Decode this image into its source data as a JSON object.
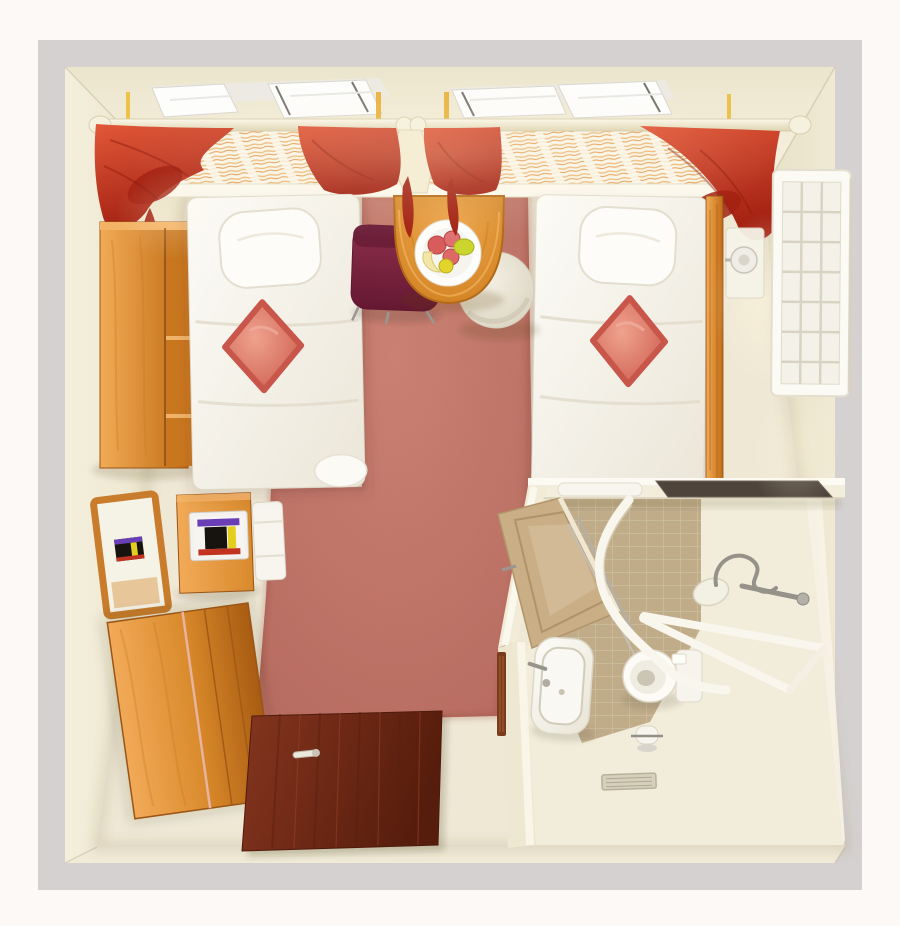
{
  "image": {
    "kind": "3d-floor-plan-render",
    "subject": "top-down view of a twin hotel guest room with accessible bathroom"
  },
  "palette": {
    "page_bg": "#fdf9f6",
    "wall_top": "#d5d1d0",
    "wall_face": "#f3eedb",
    "wall_face_dark": "#e9e1c8",
    "floor": "#efe8d5",
    "carpet": "#c5796b",
    "carpet_light": "#cf8576",
    "carpet_dark": "#a85c50",
    "wood": "#e09440",
    "wood_light": "#f2ab55",
    "wood_mid": "#d98a2c",
    "wood_dark": "#b4681f",
    "wood_deep": "#8a4b17",
    "door_wood": "#7e301d",
    "door_wood_dark": "#571d0c",
    "red": "#cc3a27",
    "red_bright": "#e25839",
    "red_dark": "#a32112",
    "cushion": "#d97163",
    "cushion_light": "#efa28f",
    "white": "#fafaf6",
    "bed_shadow": "#ddd6c6",
    "maroon": "#7d2742",
    "maroon_dark": "#651832",
    "tile": "#cab693",
    "tile_grout": "#d9cdae",
    "marble": "#f2ecda",
    "chrome": "#95928a",
    "rail_white": "#f9f6ee",
    "tan_door": "#c9ae86",
    "tv_purple": "#6a3fb5",
    "tv_yellow": "#e3cf1e",
    "tv_red": "#c23220",
    "tv_black": "#171410",
    "sheer_stripe": "#e39a4e",
    "glow": "#fff6dc"
  },
  "scene": {
    "objects": [
      "window-wall",
      "curtain-rod",
      "red-drapes",
      "sheer-curtains",
      "single-bed-left",
      "single-bed-right",
      "pillow",
      "red-diamond-cushion",
      "wall-shelf-unit",
      "wall-mirror",
      "tv-on-cabinet",
      "mini-fridge",
      "dresser",
      "breakfast-table",
      "fruit-plate",
      "dining-chair",
      "ottoman-stool",
      "nightstand",
      "wall-lamp",
      "wall-radiator-grille",
      "entrance-door",
      "bathroom",
      "bathroom-door",
      "washbasin",
      "toilet",
      "curved-shower-rail",
      "grab-rails",
      "handheld-shower",
      "toilet-paper-holder",
      "floor-drain",
      "luggage-tray",
      "carpet"
    ]
  }
}
